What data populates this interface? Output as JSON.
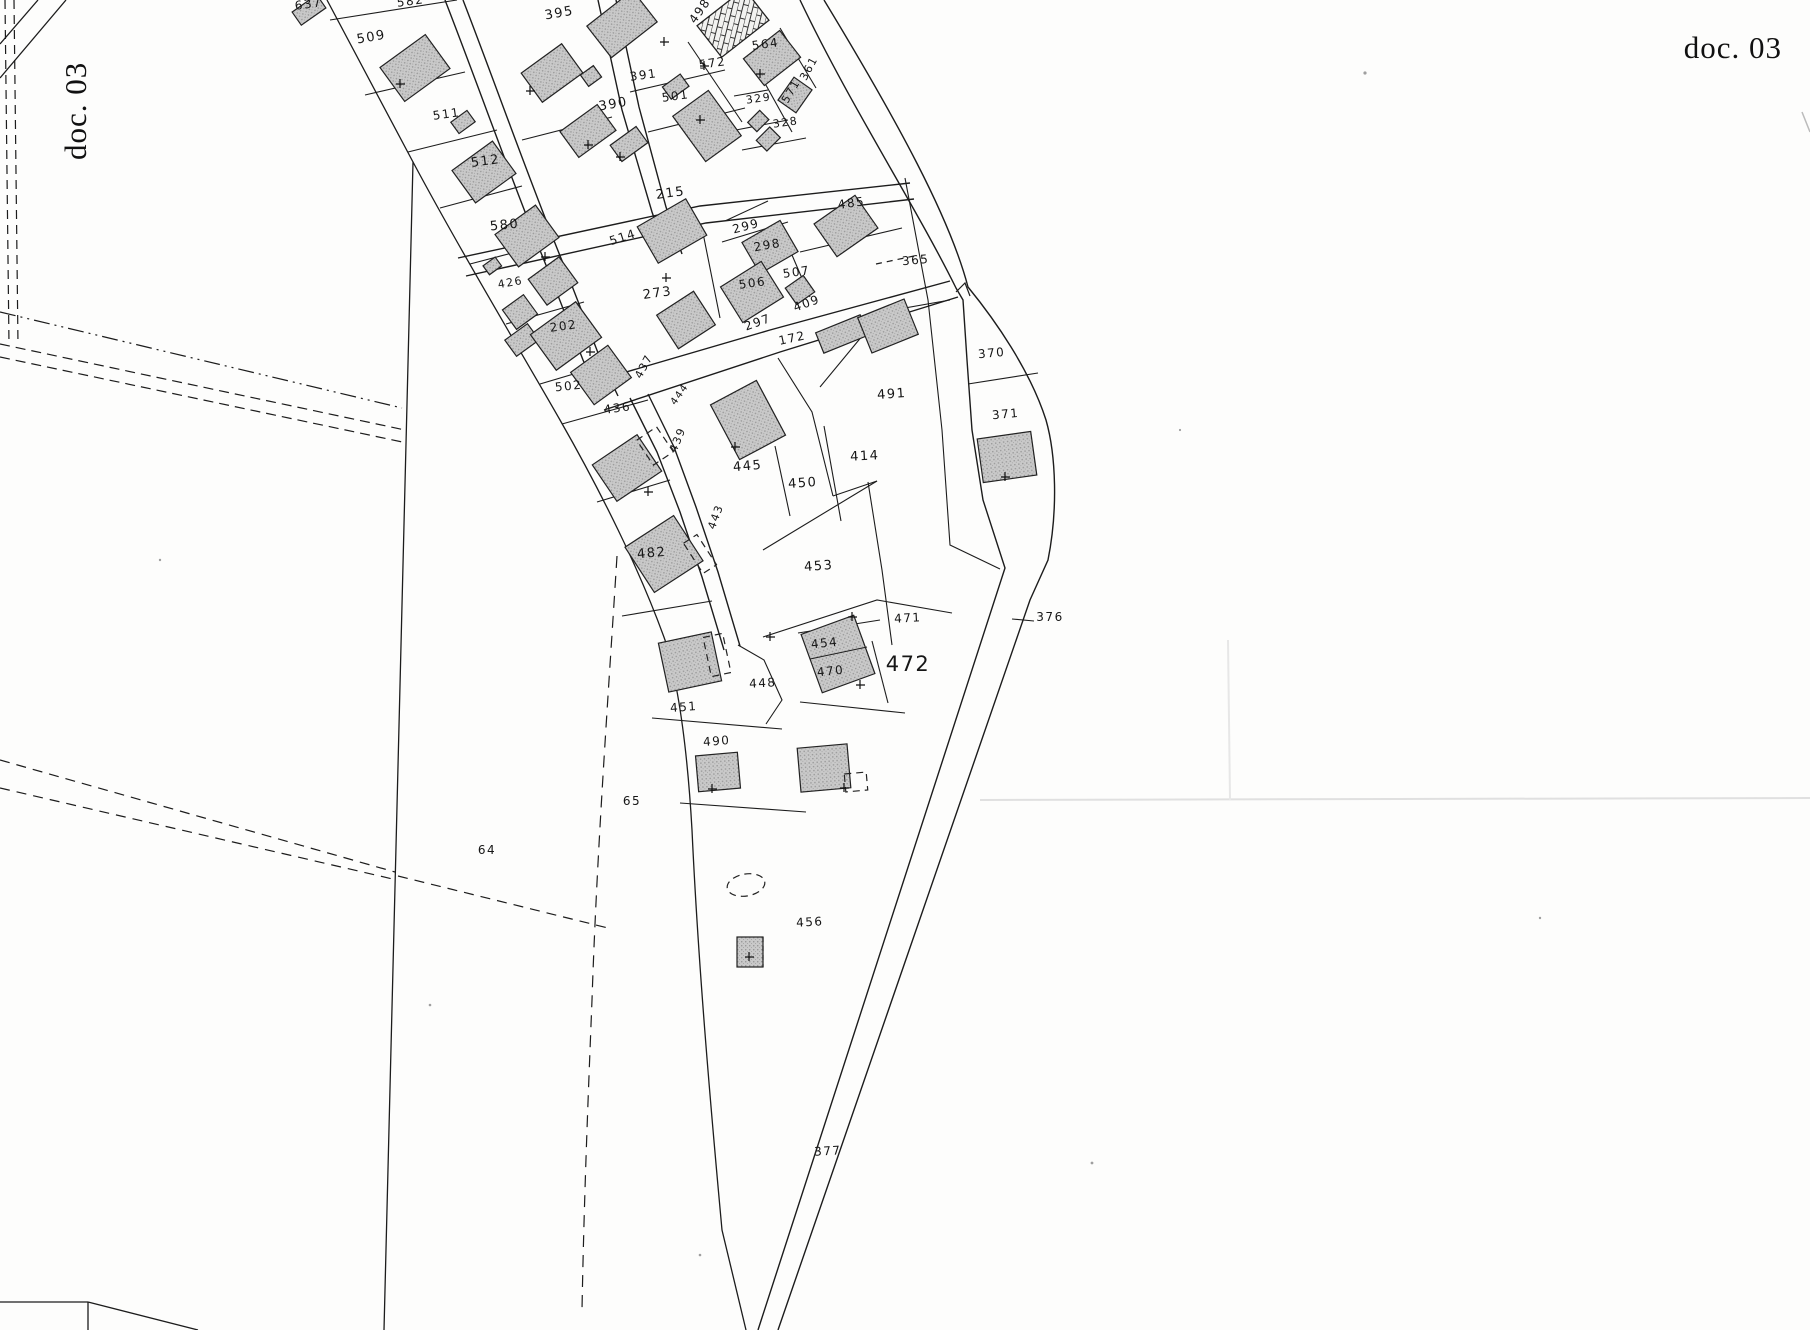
{
  "document": {
    "corner_label_top_right": "doc. 03",
    "corner_label_left_rotated": "doc. 03"
  },
  "map": {
    "type": "cadastral-plan",
    "colors": {
      "paper": "#fdfdfc",
      "line": "#1c1c1c",
      "building_fill": "#c6c6c6",
      "building_dot": "#9a9a9a",
      "building_stroke": "#222222",
      "faint_artifact": "#e0e0e0"
    },
    "leader_376": {
      "x1": 1012,
      "y1": 619,
      "x2": 1034,
      "y2": 621
    },
    "parcel_labels": [
      {
        "text": "637",
        "x": 309,
        "y": 8,
        "rot": -8,
        "fs": 12
      },
      {
        "text": "582",
        "x": 411,
        "y": 5,
        "rot": -8,
        "fs": 12
      },
      {
        "text": "509",
        "x": 372,
        "y": 41,
        "rot": -10,
        "fs": 13
      },
      {
        "text": "511",
        "x": 447,
        "y": 118,
        "rot": -8,
        "fs": 12
      },
      {
        "text": "512",
        "x": 486,
        "y": 165,
        "rot": -8,
        "fs": 13
      },
      {
        "text": "580",
        "x": 505,
        "y": 229,
        "rot": -6,
        "fs": 13
      },
      {
        "text": "426",
        "x": 511,
        "y": 286,
        "rot": -10,
        "fs": 11
      },
      {
        "text": "395",
        "x": 560,
        "y": 17,
        "rot": -10,
        "fs": 13
      },
      {
        "text": "390",
        "x": 614,
        "y": 108,
        "rot": -10,
        "fs": 13
      },
      {
        "text": "391",
        "x": 644,
        "y": 79,
        "rot": -8,
        "fs": 12
      },
      {
        "text": "501",
        "x": 676,
        "y": 100,
        "rot": -8,
        "fs": 12
      },
      {
        "text": "498",
        "x": 703,
        "y": 13,
        "rot": -55,
        "fs": 12
      },
      {
        "text": "572",
        "x": 713,
        "y": 67,
        "rot": -8,
        "fs": 12
      },
      {
        "text": "564",
        "x": 766,
        "y": 48,
        "rot": -8,
        "fs": 12
      },
      {
        "text": "361",
        "x": 812,
        "y": 70,
        "rot": -62,
        "fs": 11
      },
      {
        "text": "571",
        "x": 794,
        "y": 93,
        "rot": -60,
        "fs": 11
      },
      {
        "text": "329",
        "x": 759,
        "y": 102,
        "rot": -8,
        "fs": 11
      },
      {
        "text": "328",
        "x": 786,
        "y": 126,
        "rot": -8,
        "fs": 11
      },
      {
        "text": "215",
        "x": 671,
        "y": 197,
        "rot": -8,
        "fs": 13
      },
      {
        "text": "514",
        "x": 624,
        "y": 241,
        "rot": -18,
        "fs": 12
      },
      {
        "text": "299",
        "x": 747,
        "y": 230,
        "rot": -15,
        "fs": 12
      },
      {
        "text": "298",
        "x": 768,
        "y": 249,
        "rot": -10,
        "fs": 12
      },
      {
        "text": "485",
        "x": 852,
        "y": 207,
        "rot": -8,
        "fs": 12
      },
      {
        "text": "273",
        "x": 658,
        "y": 297,
        "rot": -8,
        "fs": 13
      },
      {
        "text": "506",
        "x": 753,
        "y": 287,
        "rot": -8,
        "fs": 12
      },
      {
        "text": "507",
        "x": 797,
        "y": 276,
        "rot": -8,
        "fs": 12
      },
      {
        "text": "365",
        "x": 916,
        "y": 264,
        "rot": -5,
        "fs": 12
      },
      {
        "text": "202",
        "x": 564,
        "y": 330,
        "rot": -8,
        "fs": 12
      },
      {
        "text": "297",
        "x": 759,
        "y": 326,
        "rot": -20,
        "fs": 12
      },
      {
        "text": "409",
        "x": 808,
        "y": 307,
        "rot": -20,
        "fs": 12
      },
      {
        "text": "172",
        "x": 793,
        "y": 342,
        "rot": -12,
        "fs": 12
      },
      {
        "text": "502",
        "x": 569,
        "y": 390,
        "rot": -6,
        "fs": 12
      },
      {
        "text": "437",
        "x": 647,
        "y": 368,
        "rot": -62,
        "fs": 11
      },
      {
        "text": "436",
        "x": 618,
        "y": 412,
        "rot": -8,
        "fs": 12
      },
      {
        "text": "444",
        "x": 682,
        "y": 396,
        "rot": -55,
        "fs": 10
      },
      {
        "text": "439",
        "x": 681,
        "y": 441,
        "rot": -68,
        "fs": 11
      },
      {
        "text": "370",
        "x": 992,
        "y": 357,
        "rot": -5,
        "fs": 12
      },
      {
        "text": "371",
        "x": 1006,
        "y": 418,
        "rot": -5,
        "fs": 12
      },
      {
        "text": "445",
        "x": 748,
        "y": 470,
        "rot": -5,
        "fs": 13
      },
      {
        "text": "450",
        "x": 803,
        "y": 487,
        "rot": -4,
        "fs": 13
      },
      {
        "text": "414",
        "x": 865,
        "y": 460,
        "rot": -3,
        "fs": 13
      },
      {
        "text": "491",
        "x": 892,
        "y": 398,
        "rot": -4,
        "fs": 13
      },
      {
        "text": "443",
        "x": 719,
        "y": 518,
        "rot": -70,
        "fs": 11
      },
      {
        "text": "482",
        "x": 652,
        "y": 557,
        "rot": -5,
        "fs": 13
      },
      {
        "text": "453",
        "x": 819,
        "y": 570,
        "rot": -4,
        "fs": 13
      },
      {
        "text": "471",
        "x": 908,
        "y": 622,
        "rot": -3,
        "fs": 12
      },
      {
        "text": "376",
        "x": 1050,
        "y": 621,
        "rot": 0,
        "fs": 12
      },
      {
        "text": "454",
        "x": 825,
        "y": 647,
        "rot": -6,
        "fs": 12
      },
      {
        "text": "470",
        "x": 831,
        "y": 675,
        "rot": -6,
        "fs": 12
      },
      {
        "text": "472",
        "x": 908,
        "y": 671,
        "rot": 0,
        "fs": 21
      },
      {
        "text": "448",
        "x": 763,
        "y": 687,
        "rot": -3,
        "fs": 12
      },
      {
        "text": "451",
        "x": 684,
        "y": 711,
        "rot": -4,
        "fs": 12
      },
      {
        "text": "490",
        "x": 717,
        "y": 745,
        "rot": -4,
        "fs": 12
      },
      {
        "text": "65",
        "x": 632,
        "y": 805,
        "rot": 0,
        "fs": 12
      },
      {
        "text": "64",
        "x": 487,
        "y": 854,
        "rot": 0,
        "fs": 12
      },
      {
        "text": "456",
        "x": 810,
        "y": 926,
        "rot": -3,
        "fs": 12
      },
      {
        "text": "377",
        "x": 828,
        "y": 1155,
        "rot": -3,
        "fs": 12
      }
    ]
  }
}
